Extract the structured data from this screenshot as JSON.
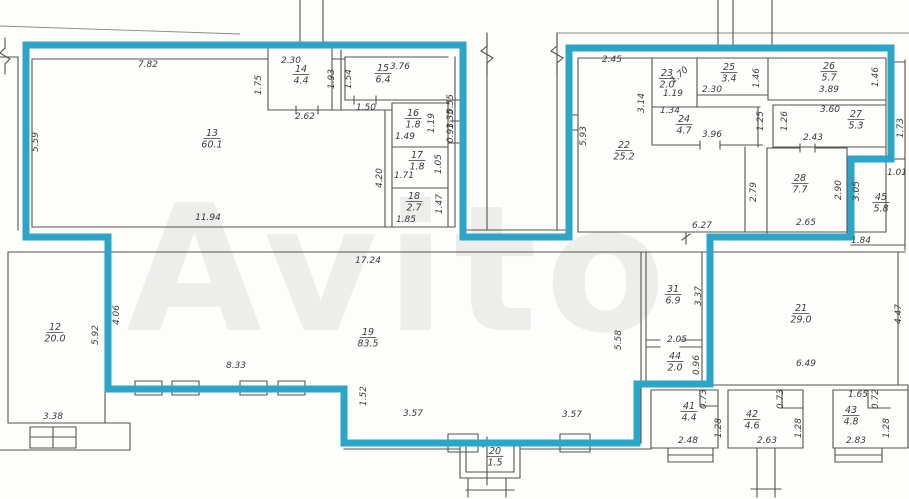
{
  "document": {
    "kind": "apartment-floor-plan",
    "highlight_note": "premises outlined in teal"
  },
  "colors": {
    "highlight": "#2BA6C9",
    "wall": "#55534F",
    "text": "#3A3A3A",
    "watermark": "#EDEDEC"
  },
  "watermark": {
    "text": "Avito"
  },
  "rooms": [
    {
      "number": "13",
      "area": "60.1",
      "x": 212,
      "y": 136
    },
    {
      "number": "14",
      "area": "4.4",
      "x": 301,
      "y": 72
    },
    {
      "number": "15",
      "area": "6.4",
      "x": 383,
      "y": 71
    },
    {
      "number": "16",
      "area": "1.8",
      "x": 413,
      "y": 116
    },
    {
      "number": "17",
      "area": "1.8",
      "x": 417,
      "y": 158
    },
    {
      "number": "18",
      "area": "2.7",
      "x": 414,
      "y": 199
    },
    {
      "number": "22",
      "area": "25.2",
      "x": 624,
      "y": 148
    },
    {
      "number": "23",
      "area": "2.0",
      "x": 667,
      "y": 76
    },
    {
      "number": "24",
      "area": "4.7",
      "x": 684,
      "y": 122
    },
    {
      "number": "25",
      "area": "3.4",
      "x": 729,
      "y": 70
    },
    {
      "number": "26",
      "area": "5.7",
      "x": 829,
      "y": 69
    },
    {
      "number": "27",
      "area": "5.3",
      "x": 856,
      "y": 117
    },
    {
      "number": "28",
      "area": "7.7",
      "x": 800,
      "y": 181
    },
    {
      "number": "45",
      "area": "5.8",
      "x": 881,
      "y": 200
    },
    {
      "number": "12",
      "area": "20.0",
      "x": 55,
      "y": 330
    },
    {
      "number": "19",
      "area": "83.5",
      "x": 368,
      "y": 335
    },
    {
      "number": "20",
      "area": "1.5",
      "x": 495,
      "y": 454
    },
    {
      "number": "21",
      "area": "29.0",
      "x": 801,
      "y": 311
    },
    {
      "number": "31",
      "area": "6.9",
      "x": 673,
      "y": 292
    },
    {
      "number": "44",
      "area": "2.0",
      "x": 675,
      "y": 359
    },
    {
      "number": "41",
      "area": "4.4",
      "x": 689,
      "y": 409
    },
    {
      "number": "42",
      "area": "4.6",
      "x": 752,
      "y": 417
    },
    {
      "number": "43",
      "area": "4.8",
      "x": 851,
      "y": 413
    }
  ],
  "dims": [
    {
      "v": "7.82",
      "x": 148,
      "y": 67,
      "r": 0
    },
    {
      "v": "5.59",
      "x": 38,
      "y": 142,
      "r": -90
    },
    {
      "v": "11.94",
      "x": 208,
      "y": 220,
      "r": 0
    },
    {
      "v": "1.75",
      "x": 261,
      "y": 85,
      "r": -90
    },
    {
      "v": "2.30",
      "x": 291,
      "y": 63,
      "r": 0
    },
    {
      "v": "1.93",
      "x": 334,
      "y": 79,
      "r": -90
    },
    {
      "v": "2.62",
      "x": 305,
      "y": 119,
      "r": 0
    },
    {
      "v": "1.54",
      "x": 351,
      "y": 79,
      "r": -90
    },
    {
      "v": "3.76",
      "x": 400,
      "y": 69,
      "r": 0
    },
    {
      "v": "1.50",
      "x": 366,
      "y": 110,
      "r": 0
    },
    {
      "v": "4.20",
      "x": 382,
      "y": 178,
      "r": -90
    },
    {
      "v": "1.49",
      "x": 405,
      "y": 139,
      "r": 0
    },
    {
      "v": "1.19",
      "x": 434,
      "y": 123,
      "r": -90
    },
    {
      "v": "0.55",
      "x": 453,
      "y": 104,
      "r": -90,
      "s": 6
    },
    {
      "v": "1.35",
      "x": 453,
      "y": 119,
      "r": -90,
      "s": 6
    },
    {
      "v": "0.93",
      "x": 453,
      "y": 133,
      "r": -90,
      "s": 6
    },
    {
      "v": "1.71",
      "x": 404,
      "y": 178,
      "r": 0
    },
    {
      "v": "1.05",
      "x": 441,
      "y": 164,
      "r": -90
    },
    {
      "v": "1.85",
      "x": 406,
      "y": 222,
      "r": 0
    },
    {
      "v": "1.47",
      "x": 442,
      "y": 204,
      "r": -90
    },
    {
      "v": "2.45",
      "x": 612,
      "y": 62,
      "r": 0
    },
    {
      "v": "5.93",
      "x": 586,
      "y": 136,
      "r": -90
    },
    {
      "v": "3.14",
      "x": 644,
      "y": 103,
      "r": -90
    },
    {
      "v": "1.70",
      "x": 681,
      "y": 77,
      "r": -40
    },
    {
      "v": "1.19",
      "x": 673,
      "y": 96,
      "r": 0,
      "s": 8
    },
    {
      "v": "1.34",
      "x": 670,
      "y": 113,
      "r": 0,
      "s": 8
    },
    {
      "v": "2.30",
      "x": 712,
      "y": 92,
      "r": 0
    },
    {
      "v": "1.46",
      "x": 759,
      "y": 78,
      "r": -90
    },
    {
      "v": "3.89",
      "x": 829,
      "y": 92,
      "r": 0
    },
    {
      "v": "1.46",
      "x": 878,
      "y": 77,
      "r": -90
    },
    {
      "v": "3.96",
      "x": 712,
      "y": 137,
      "r": 0
    },
    {
      "v": "1.25",
      "x": 763,
      "y": 121,
      "r": -90
    },
    {
      "v": "1.26",
      "x": 787,
      "y": 121,
      "r": -90
    },
    {
      "v": "3.60",
      "x": 830,
      "y": 112,
      "r": 0
    },
    {
      "v": "2.43",
      "x": 813,
      "y": 140,
      "r": 0
    },
    {
      "v": "2.79",
      "x": 756,
      "y": 192,
      "r": -90
    },
    {
      "v": "2.90",
      "x": 841,
      "y": 190,
      "r": -90
    },
    {
      "v": "3.05",
      "x": 859,
      "y": 191,
      "r": -90
    },
    {
      "v": "2.65",
      "x": 806,
      "y": 225,
      "r": 0
    },
    {
      "v": "6.27",
      "x": 702,
      "y": 228,
      "r": 0
    },
    {
      "v": "1.73",
      "x": 903,
      "y": 128,
      "r": -90
    },
    {
      "v": "1.01",
      "x": 897,
      "y": 175,
      "r": 0
    },
    {
      "v": "1.84",
      "x": 861,
      "y": 243,
      "r": 0
    },
    {
      "v": "3.38",
      "x": 53,
      "y": 419,
      "r": 0
    },
    {
      "v": "5.92",
      "x": 98,
      "y": 335,
      "r": -90
    },
    {
      "v": "4.06",
      "x": 119,
      "y": 315,
      "r": -90
    },
    {
      "v": "17.24",
      "x": 368,
      "y": 263,
      "r": 0
    },
    {
      "v": "8.33",
      "x": 236,
      "y": 368,
      "r": 0
    },
    {
      "v": "1.52",
      "x": 366,
      "y": 396,
      "r": -90
    },
    {
      "v": "3.57",
      "x": 413,
      "y": 416,
      "r": 0
    },
    {
      "v": "3.57",
      "x": 572,
      "y": 417,
      "r": 0
    },
    {
      "v": "5.58",
      "x": 621,
      "y": 340,
      "r": -90
    },
    {
      "v": "3.37",
      "x": 701,
      "y": 296,
      "r": -90
    },
    {
      "v": "2.05",
      "x": 677,
      "y": 342,
      "r": 0
    },
    {
      "v": "0.96",
      "x": 699,
      "y": 365,
      "r": -90
    },
    {
      "v": "6.49",
      "x": 806,
      "y": 366,
      "r": 0
    },
    {
      "v": "4.47",
      "x": 901,
      "y": 314,
      "r": -90
    },
    {
      "v": "0.73",
      "x": 706,
      "y": 399,
      "r": -90
    },
    {
      "v": "1.28",
      "x": 721,
      "y": 428,
      "r": -90
    },
    {
      "v": "2.48",
      "x": 688,
      "y": 443,
      "r": 0
    },
    {
      "v": "0.73",
      "x": 783,
      "y": 399,
      "r": -90
    },
    {
      "v": "1.28",
      "x": 801,
      "y": 428,
      "r": -90
    },
    {
      "v": "2.63",
      "x": 767,
      "y": 443,
      "r": 0
    },
    {
      "v": "1.65",
      "x": 858,
      "y": 397,
      "r": 0
    },
    {
      "v": "0.72",
      "x": 878,
      "y": 399,
      "r": -90
    },
    {
      "v": "1.28",
      "x": 889,
      "y": 428,
      "r": -90
    },
    {
      "v": "2.83",
      "x": 856,
      "y": 443,
      "r": 0
    }
  ]
}
